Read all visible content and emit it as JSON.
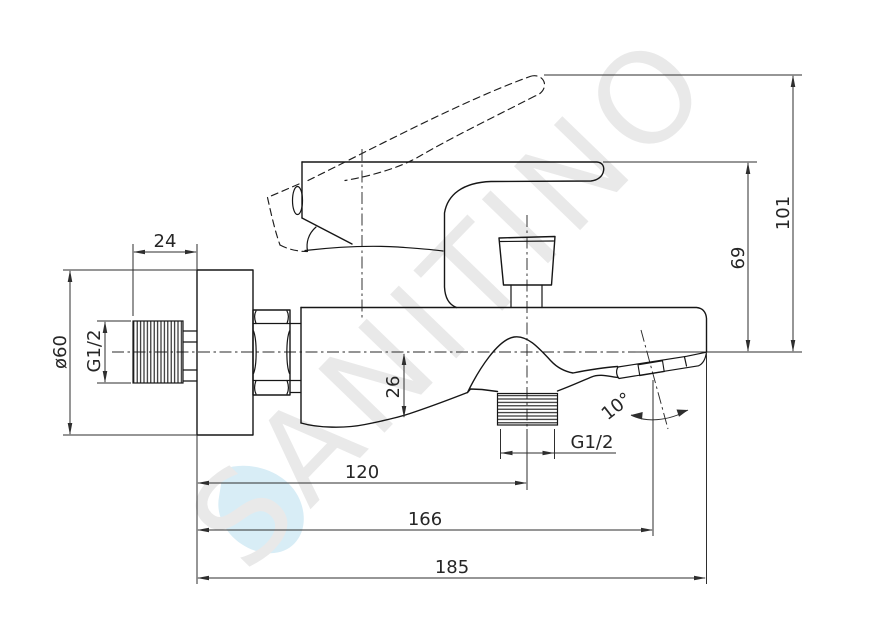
{
  "watermark": {
    "text": "SANITINO"
  },
  "colors": {
    "line": "#161616",
    "dimension_line": "#2e2e2e",
    "watermark_text": "#e9e9e9",
    "watermark_drop": "#d8edf6",
    "background": "#ffffff"
  },
  "labels": {
    "eccentric_length": "24",
    "flange_diameter": "ø60",
    "inlet_thread": "G1/2",
    "overall_height": "101",
    "body_height": "69",
    "spout_drop": "26",
    "shower_outlet_thread": "G1/2",
    "spout_angle": "10°",
    "wall_to_shower_outlet": "120",
    "wall_to_aerator": "166",
    "wall_to_spout_tip": "185"
  }
}
